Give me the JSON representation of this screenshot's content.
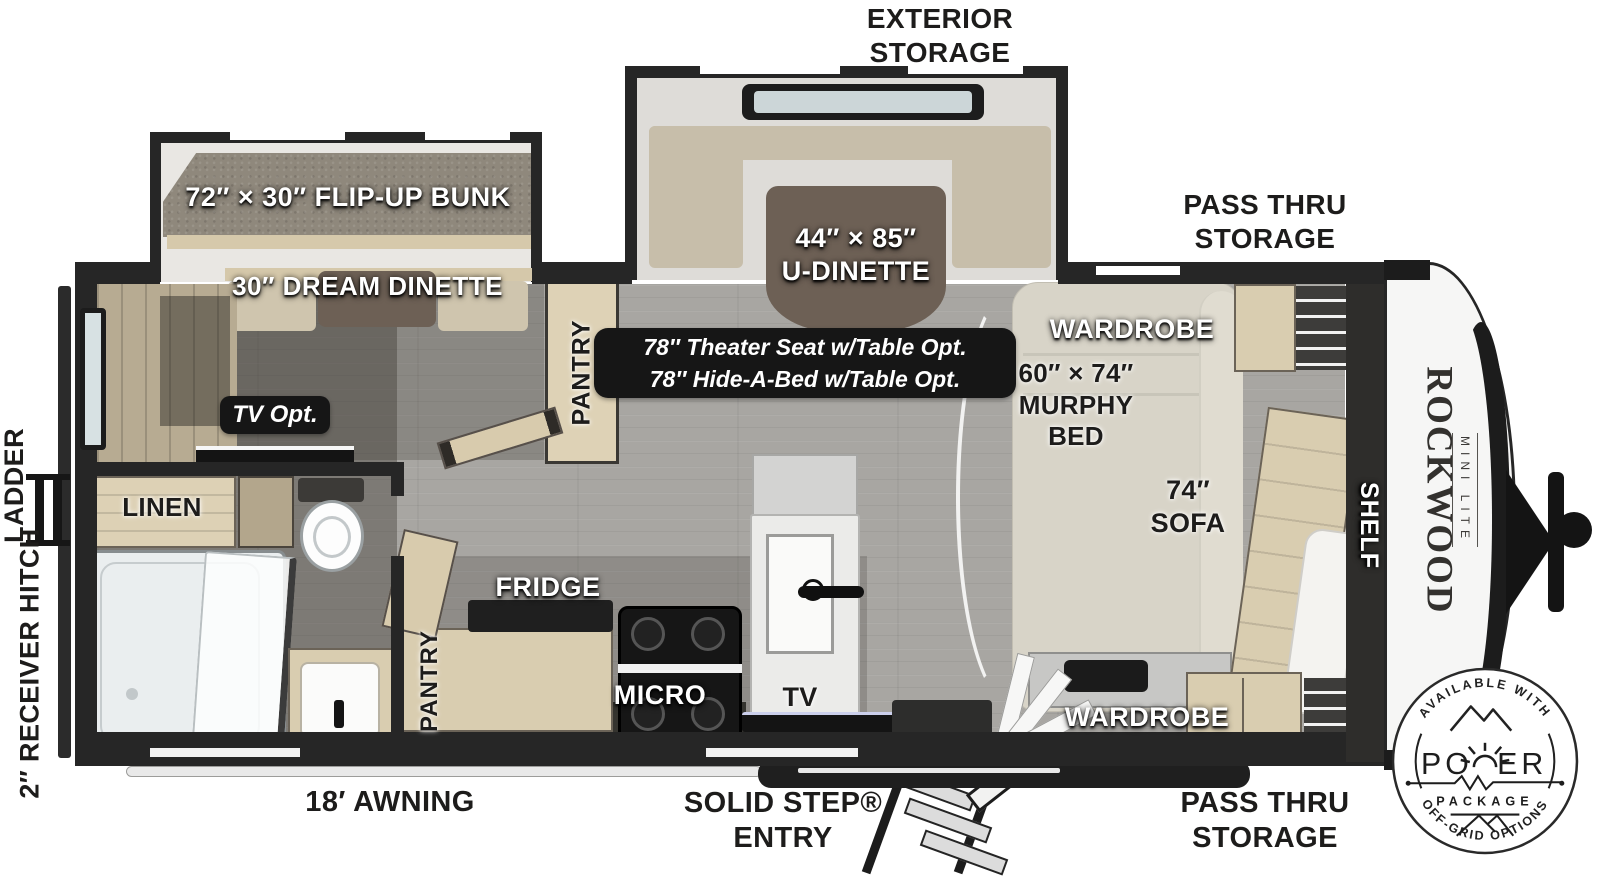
{
  "title": "Rockwood Mini Lite travel trailer floor plan",
  "brand": {
    "name": "ROCKWOOD",
    "sub": "MINI LITE"
  },
  "colors": {
    "wall": "#262626",
    "wood": "#d9cdb0",
    "cushion": "#c7beaa",
    "table": "#6d6055",
    "floor": "#a8a6a2",
    "badge_black": "#161616",
    "background": "#ffffff"
  },
  "exterior": {
    "exterior_storage": "EXTERIOR\nSTORAGE",
    "pass_thru_top": "PASS THRU\nSTORAGE",
    "pass_thru_bottom": "PASS THRU\nSTORAGE",
    "awning": "18′ AWNING",
    "solid_step": "SOLID STEP®\nENTRY",
    "ladder": "LADDER",
    "receiver_hitch": "2″ RECEIVER\nHITCH"
  },
  "rooms": {
    "flip_up_bunk": "72″ × 30″ FLIP-UP BUNK",
    "dream_dinette": "30″ DREAM DINETTE",
    "u_dinette": "44″ × 85″\nU-DINETTE",
    "theater_option": "78″ Theater Seat w/Table Opt.\n78″ Hide-A-Bed w/Table Opt.",
    "wardrobe_top": "WARDROBE",
    "wardrobe_bottom": "WARDROBE",
    "murphy_bed": "60″ × 74″\nMURPHY\nBED",
    "sofa": "74″\nSOFA",
    "shelf": "SHELF",
    "pantry_upper": "PANTRY",
    "pantry_lower": "PANTRY",
    "fridge": "FRIDGE",
    "micro": "MICRO",
    "tv": "TV",
    "tv_option": "TV Opt.",
    "linen": "LINEN"
  },
  "badge": {
    "top": "AVAILABLE WITH",
    "power_left": "PO",
    "power_right": "ER",
    "package": "PACKAGE",
    "bottom": "OFF-GRID OPTIONS"
  }
}
